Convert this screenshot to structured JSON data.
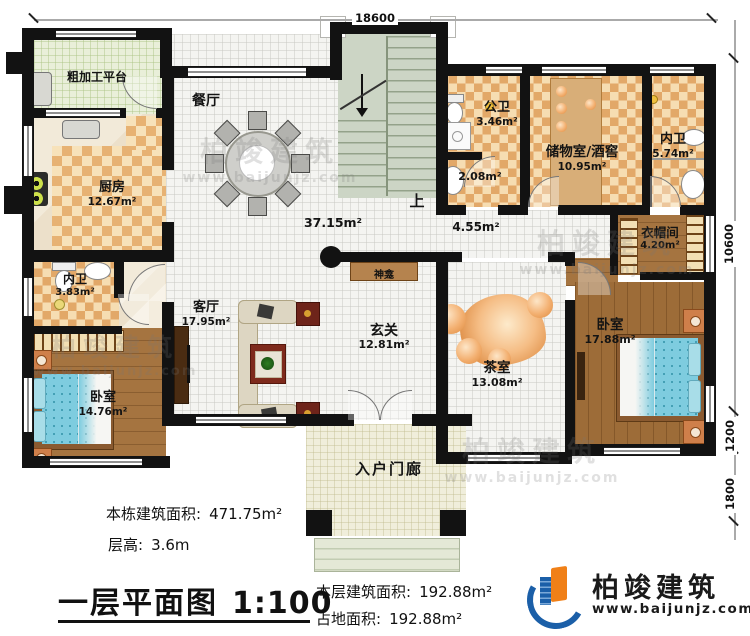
{
  "rooms": {
    "platform": {
      "name": "粗加工平台"
    },
    "kitchen": {
      "name": "厨房",
      "area": "12.67m²"
    },
    "dining": {
      "name": "餐厅"
    },
    "open_space": {
      "area": "37.15m²"
    },
    "stairs": {
      "up": "上"
    },
    "public_wc": {
      "name": "公卫",
      "area": "3.46m²"
    },
    "wc_annex": {
      "area": "2.08m²"
    },
    "storage": {
      "name": "储物室/酒窖",
      "area": "10.95m²"
    },
    "ensuite_right": {
      "name": "内卫",
      "area": "5.74m²"
    },
    "corridor": {
      "area": "4.55m²"
    },
    "cloakroom": {
      "name": "衣帽间",
      "area": "4.20m²"
    },
    "bedroom_right": {
      "name": "卧室",
      "area": "17.88m²"
    },
    "shrine": {
      "name": "神龛"
    },
    "living": {
      "name": "客厅",
      "area": "17.95m²"
    },
    "foyer": {
      "name": "玄关",
      "area": "12.81m²"
    },
    "tea_room": {
      "name": "茶室",
      "area": "13.08m²"
    },
    "ensuite_left": {
      "name": "内卫",
      "area": "3.83m²"
    },
    "bedroom_left": {
      "name": "卧室",
      "area": "14.76m²"
    },
    "porch": {
      "name": "入户门廊"
    }
  },
  "dimensions": {
    "top": "18600",
    "right_upper": "10600",
    "right_middle": "1200",
    "right_lower": "1800"
  },
  "info": {
    "total_area_label": "本栋建筑面积:",
    "total_area_value": "471.75m²",
    "floor_height_label": "层高:",
    "floor_height_value": "3.6m",
    "plan_title": "一层平面图",
    "plan_scale": "1:100",
    "floor_area_label": "本层建筑面积:",
    "floor_area_value": "192.88m²",
    "site_area_label": "占地面积:",
    "site_area_value": "192.88m²"
  },
  "brand": {
    "name": "柏竣建筑",
    "website": "www.baijunjz.com"
  },
  "watermark": {
    "name": "柏竣建筑",
    "website": "www.baijunjz.com"
  },
  "colors": {
    "wall": "#121212",
    "checker_tile": "#e7b273",
    "wood_floor": "#a57440",
    "bed": "#7eccdf",
    "rock": "#e8954e",
    "brand_blue": "#1b5fa8",
    "brand_orange": "#f08018"
  }
}
